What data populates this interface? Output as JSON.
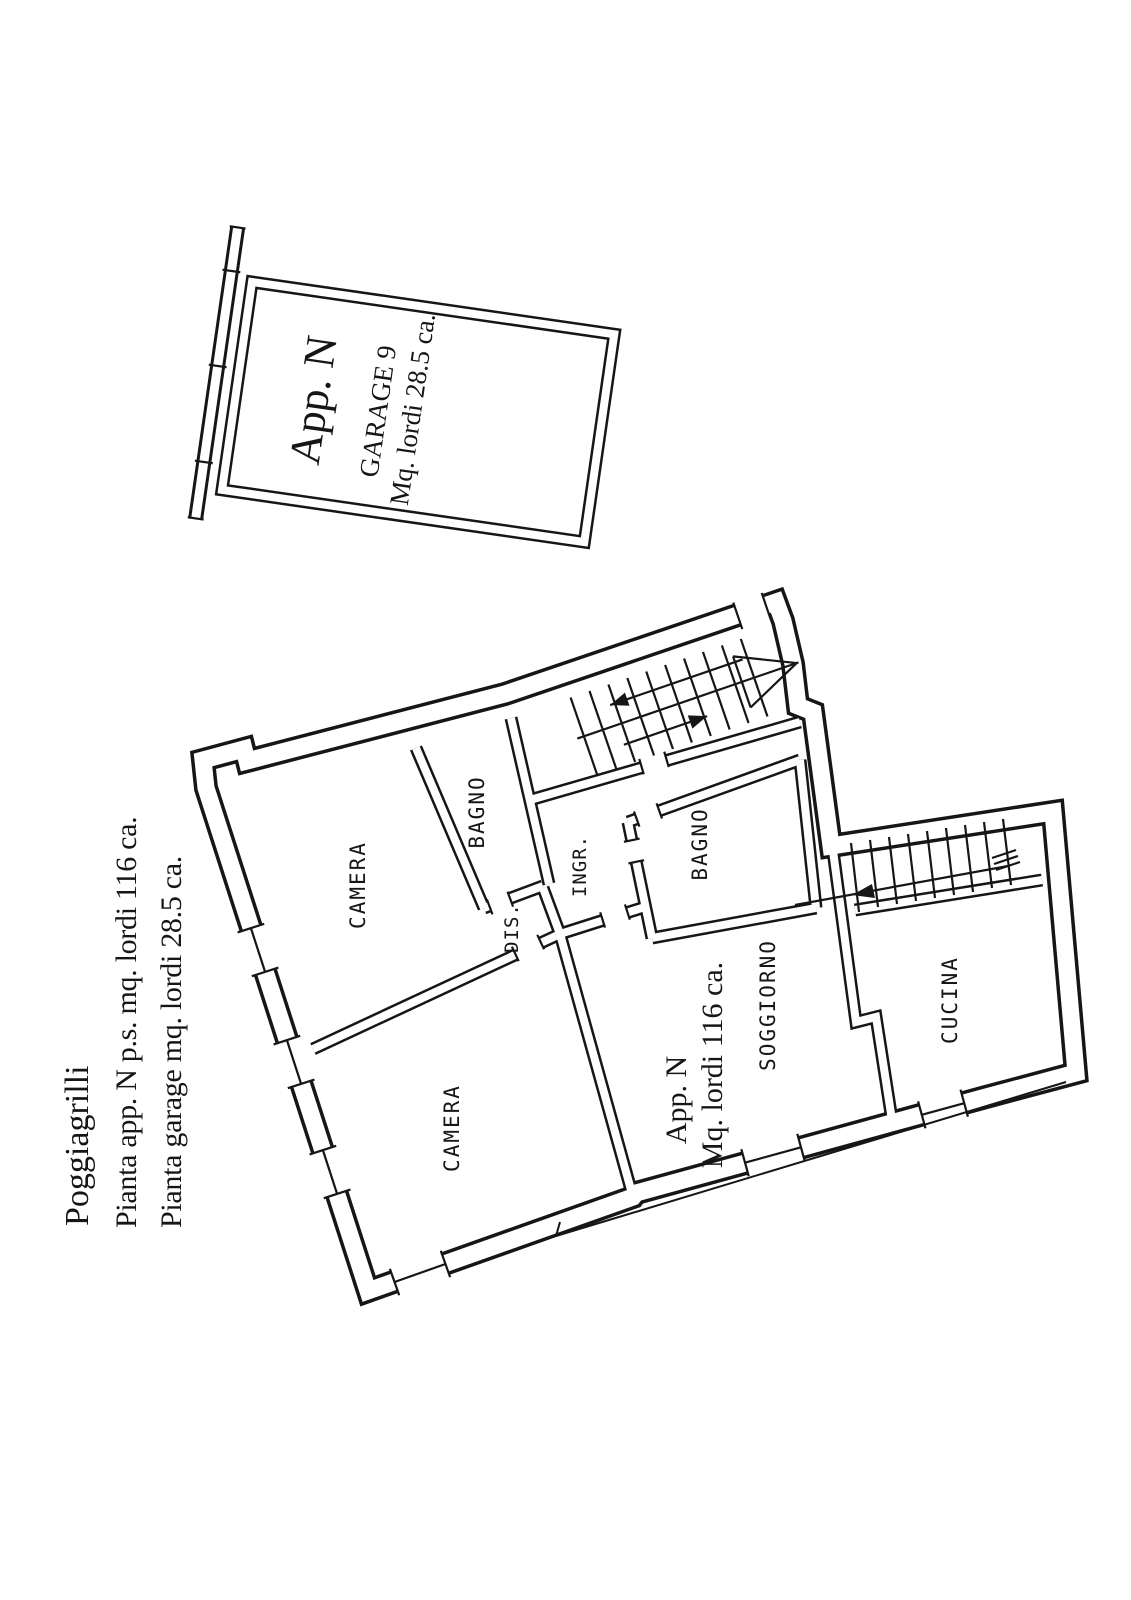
{
  "page": {
    "background": "#ffffff",
    "ink": "#161616",
    "kind": "scanned floor plan drawing"
  },
  "title_block": {
    "line1": "Poggiagrilli",
    "line2": "Pianta app. N p.s. mq. lordi 116 ca.",
    "line3": "Pianta garage mq. lordi 28.5 ca."
  },
  "garage_plan": {
    "unit_label": "App. N",
    "room_label": "GARAGE 9",
    "area_label": "Mq. lordi 28.5 ca."
  },
  "apartment_plan": {
    "unit_label": "App. N",
    "area_label": "Mq. lordi 116 ca.",
    "rooms": [
      {
        "label": "CAMERA"
      },
      {
        "label": "BAGNO"
      },
      {
        "label": "DIS."
      },
      {
        "label": "INGR."
      },
      {
        "label": "BAGNO"
      },
      {
        "label": "CAMERA"
      },
      {
        "label": "SOGGIORNO"
      },
      {
        "label": "CUCINA"
      }
    ]
  }
}
